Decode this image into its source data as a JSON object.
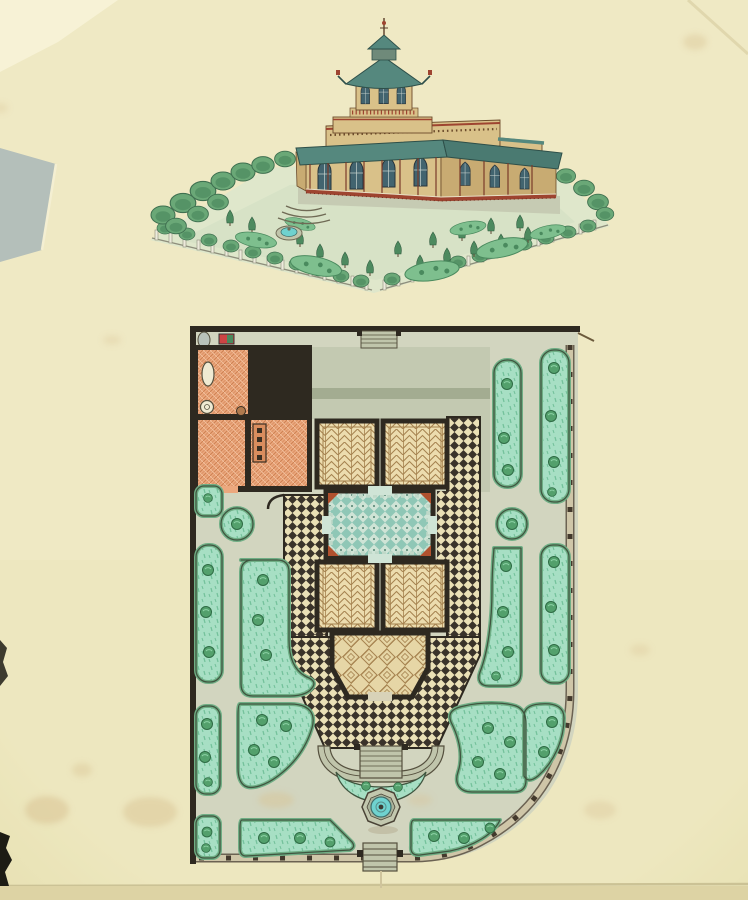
{
  "document": {
    "kind": "scanned watercolour architectural drawing",
    "text_content": "none — the sheet carries no lettering, only drawn imagery",
    "sections": [
      "perspective view of pavilion and garden (top)",
      "ground-floor and garden plan (bottom)"
    ]
  },
  "labels": {
    "drawing": "Watercolour architectural drawing of a garden pavilion: bird's-eye perspective view above, ground-floor and garden plan below, on cream laid paper with stains and torn edges",
    "perspective": "Perspective view of a pavilion with an octagonal lantern tower, pagoda roof with spire, pointed-arch windows, teal verandah awning, red railing, fenced garden with tree rows, parterre beds and a fountain",
    "plan": "Site plan: orange-hatched service rooms, grey terrace with steps, four herringbone-parquet rooms around a teal-tiled central hall, diamond-parquet salon, black-and-cream chequered terraces, curved semicircular garden stair, teal garden beds with shrubs, octagonal fountain, fenced boundary with gates"
  },
  "palette": {
    "paper": "#efe9c4",
    "paperShade": "#e4dcab",
    "paperEdge": "#cbc295",
    "scanDark": "#1d1c15",
    "stain": "#d9c394",
    "tornPatch": "#b4bfba",
    "lightPatch": "#f7f2d6",
    "pathGray": "#d2d5bf",
    "terrace": "#c3c9b1",
    "terraceBand": "#a3ac91",
    "stone": "#c0c5ab",
    "stoneDark": "#6f6a55",
    "wall": "#2e2920",
    "fenceBand": "#cfc6a8",
    "fenceDark": "#43392c",
    "fenceEdge": "#6b6252",
    "checkerDark": "#3a332a",
    "checkerLight": "#eae0b6",
    "parquet": "#ecdcae",
    "parquetLine": "#a5824f",
    "diamondBg": "#e6d6a6",
    "orange": "#eca87e",
    "orangeLine": "#cd8152",
    "orangeLite": "#f3c6a4",
    "hallLight": "#cfe4d6",
    "hallTeal": "#8fc7b6",
    "hallDark": "#50806f",
    "hallRed": "#b0512e",
    "bed": "#a7dfc4",
    "bedDash": "#74c19b",
    "bedRim": "#6fae85",
    "bedEdge": "#3f553f",
    "tree": "#53a06c",
    "treeDark": "#2e6b44",
    "treeLite": "#8fd4a8",
    "water": "#6fd2cf",
    "waterDark": "#3f6f6c",
    "bTan": "#d9c189",
    "bTanDark": "#c8ab72",
    "bRoof": "#55887e",
    "bRoofDk": "#2e4f49",
    "bRed": "#9e4430",
    "bWin": "#42646f",
    "bLine": "#6b4a2a",
    "leafA": "#6aa877",
    "leafB": "#4d8a5f",
    "leafC": "#84b98d",
    "hedge": "#57925f",
    "fencePost": "#eceadb",
    "fenceLine": "#8e8e7c",
    "groundWash": "#dfe7cb",
    "groundWash2": "#cfdfc2",
    "parterre": "#7ebf8e",
    "parterreDark": "#4a8a5e"
  },
  "perspective_view": {
    "building": {
      "walls": "tan with gothic pointed-arch windows",
      "tower": "octagonal lantern, balustrade, teal pagoda roof, cupola and spire with finial ball",
      "verandah": "teal awning on slender red-brown posts above a red railing",
      "annex": "lower wing to the right"
    },
    "garden": {
      "enclosure": "light picket fence on all sides with hedge and tree rows",
      "features": [
        "parterre beds",
        "small circular fountain left of centre",
        "stair at front-left of the pavilion"
      ]
    }
  },
  "site_plan": {
    "building": {
      "service_wing": "three rooms with orange cross-hatched floors, stoves and fixtures (north-west corner)",
      "terrace": "grey verandah strip along the north side with central entrance steps",
      "rooms": [
        {
          "position": "north-west",
          "floor": "herringbone parquet"
        },
        {
          "position": "north-east",
          "floor": "herringbone parquet"
        },
        {
          "position": "centre",
          "floor": "teal diagonal tile hall with red corner pieces"
        },
        {
          "position": "south-west",
          "floor": "herringbone parquet"
        },
        {
          "position": "south-east",
          "floor": "herringbone parquet"
        },
        {
          "position": "south bay",
          "floor": "diamond square-in-square parquet salon with canted corners"
        }
      ],
      "surround": "black-and-cream chequered terrace wrapping the south half, ending in a semicircular garden stair"
    },
    "garden": {
      "beds": "teal rounded beds with shrub symbols: long pills along west and east sides, two circular beds, comma-shaped beds flanking the stair, beds following the curved south-east corner and the south fence",
      "fountain": "octagonal basin with turquoise water south of the stair",
      "gates": "entrance steps at top centre and bottom centre of the boundary",
      "boundary": "thick black wall lines on north and west, post-and-rail fence on east and curved south-east corner"
    }
  },
  "paper_features": [
    "grey-blue torn patch on left edge",
    "lighter torn corner top-left",
    "fox-spot stains lower-left and top",
    "crease across top-right corner",
    "horizontal fold near bottom edge",
    "dark scanner background showing at ragged left edge"
  ]
}
